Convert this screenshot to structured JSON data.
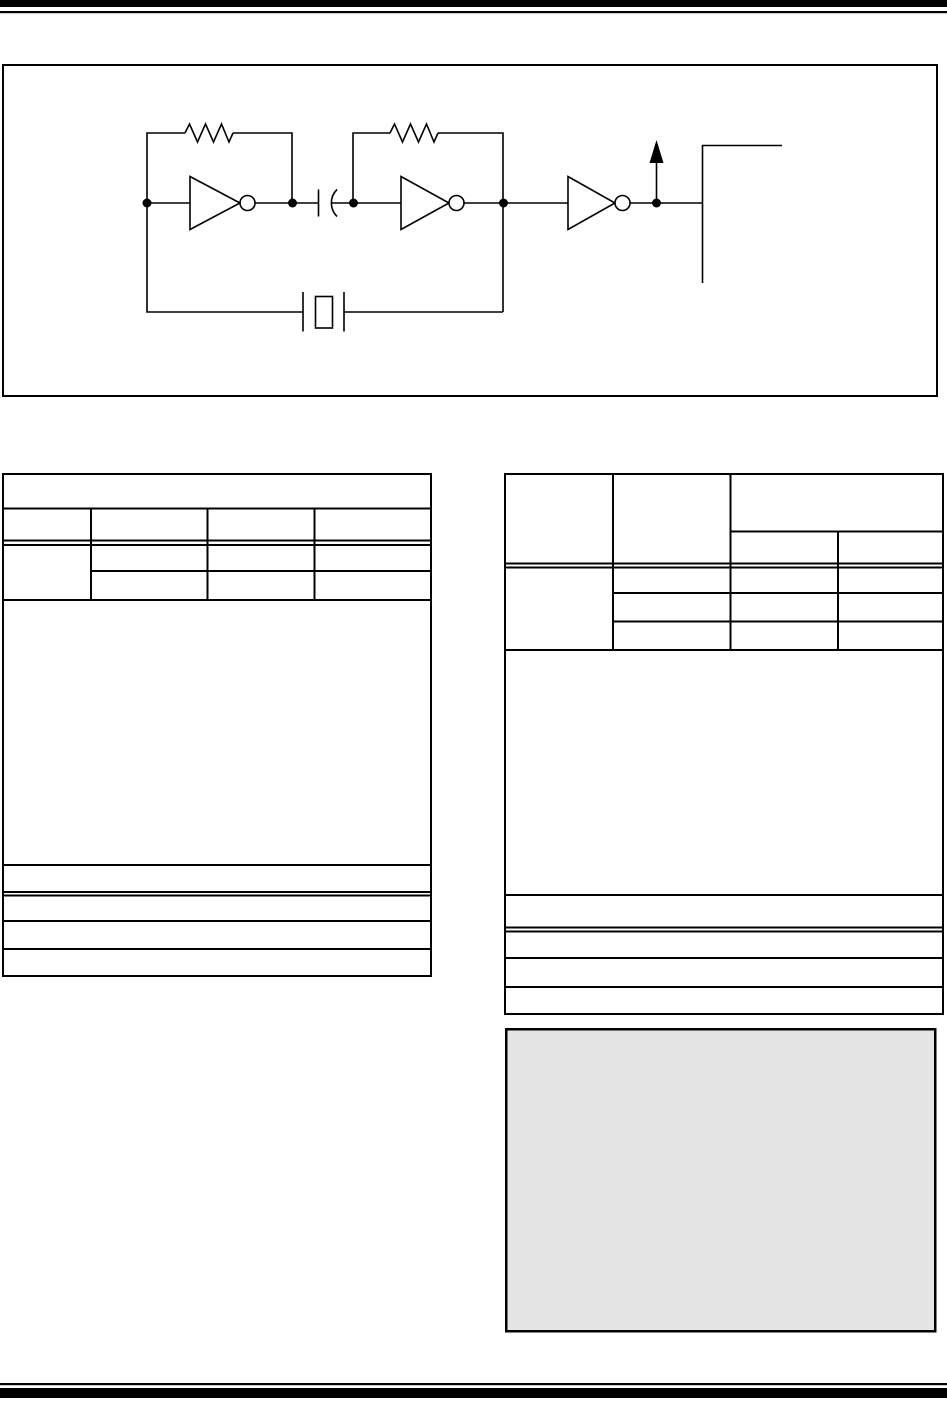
{
  "colors": {
    "line-color": "#000000",
    "page-bg": "#ffffff",
    "note-fill": "#e5e5e5"
  },
  "figure": {
    "type": "circuit-schematic",
    "visible_text": "",
    "components": [
      "inverter-1",
      "inverter-2",
      "inverter-3",
      "feedback-resistor-1",
      "feedback-resistor-2",
      "coupling-capacitor",
      "quartz-crystal",
      "output-arrow",
      "output-corner-bracket"
    ]
  },
  "left_table": {
    "column_count": 4,
    "header_rows": 2,
    "sub_rows": 2,
    "footer_rows": 4,
    "visible_text": ""
  },
  "right_table": {
    "column_count": 4,
    "header_rows": 2,
    "body_rows": 3,
    "footer_rows": 4,
    "visible_text": ""
  },
  "note_box": {
    "visible_text": ""
  }
}
